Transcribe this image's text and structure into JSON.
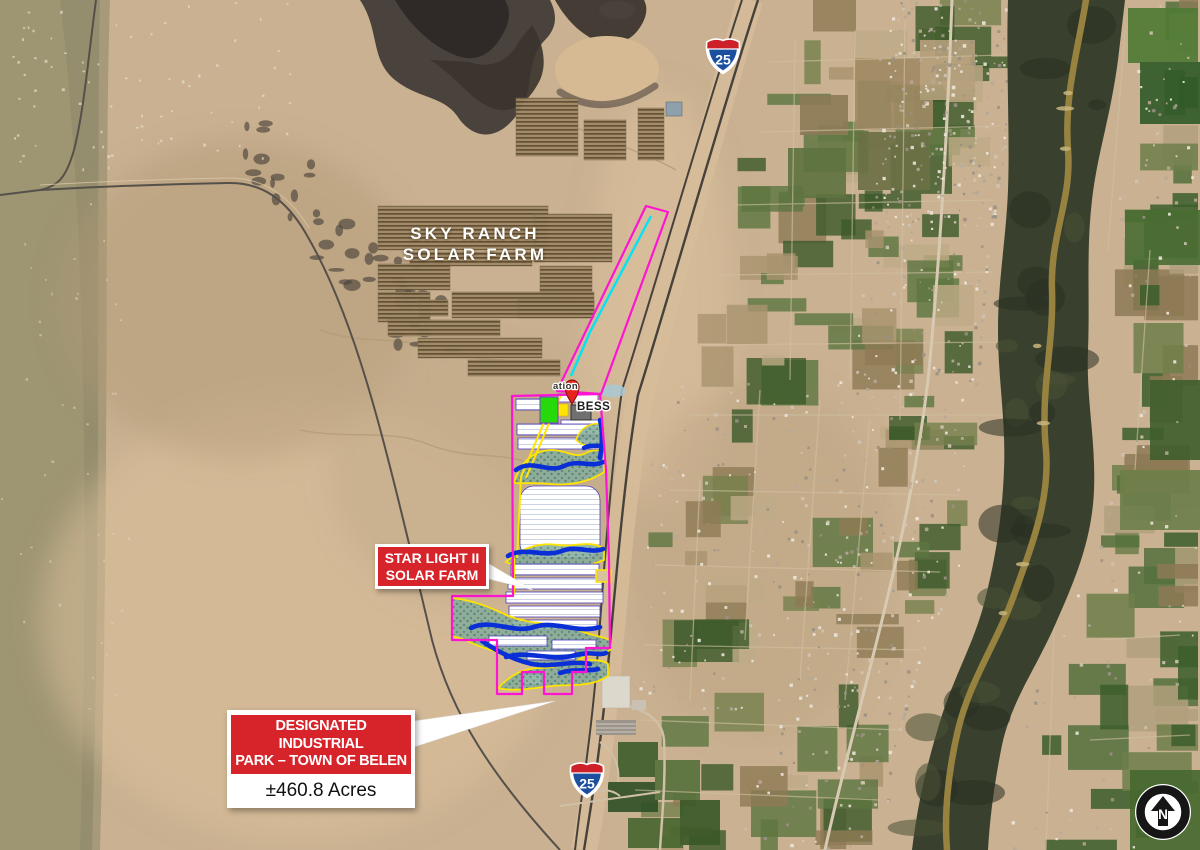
{
  "map": {
    "labels": {
      "sky_ranch": {
        "line1": "SKY RANCH",
        "line2": "SOLAR FARM"
      },
      "star_light": {
        "line1": "STAR LIGHT II",
        "line2": "SOLAR FARM"
      },
      "industrial_park": {
        "line1": "DESIGNATED INDUSTRIAL",
        "line2": "PARK – TOWN OF BELEN",
        "acreage": "±460.8 Acres"
      },
      "substation_partial": "ation",
      "bess": "BESS"
    },
    "route_shields": [
      {
        "type": "interstate",
        "number": "25"
      },
      {
        "type": "interstate",
        "number": "25"
      }
    ],
    "north_arrow": {
      "letter": "N"
    },
    "colors": {
      "site_boundary": "#ff14d2",
      "gen_tie_line": "#00e4f6",
      "drainage_channel": "#0b2fd6",
      "drainage_area_outline": "#ffe400",
      "callout_red": "#d7242b"
    }
  }
}
